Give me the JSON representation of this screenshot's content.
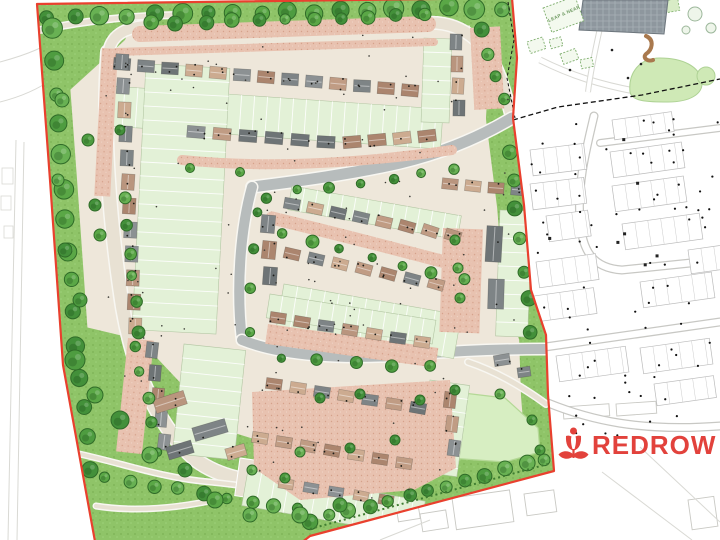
{
  "labels": {
    "play_area": "LEAP & NEAP",
    "brand": "REDROW"
  },
  "logo": {
    "text": "REDROW",
    "color": "#e2423c",
    "x": 592,
    "y": 454,
    "size": 26
  },
  "colors": {
    "boundary_red": "#e9402e",
    "base": "#eee7da",
    "grass": "#8fc468",
    "grass_dot1": "#7cb254",
    "grass_dot2": "#9ed27a",
    "lawn_edge": "#7ab153",
    "basin": "#d7eec2",
    "basin_edge": "#b4d896",
    "road_gray": "#b7bcbc",
    "road_beige": "#e8e1d3",
    "road_casing": "#f8f7f2",
    "salmon": "#e8c2b0",
    "salmon_dot": "#d5a18b",
    "garden": "#e3f1d7",
    "garden_edge": "#b3c6a3",
    "roofs": [
      "#6e7476",
      "#b9957e",
      "#ccab90",
      "#7e8486",
      "#ab856e",
      "#8c9193",
      "#c09c84"
    ],
    "tree_fills": [
      "#5aa746",
      "#4e9c40",
      "#68b153",
      "#43903a"
    ],
    "tree_edge": "#2f6b28",
    "estate_line": "#bbbbbb",
    "estate_road": "#c8c8c4",
    "faint": "#d9d9d4",
    "panel": "#8e979e",
    "panel_line": "#a8b1b6",
    "play_green": "#7fae6e",
    "blob": "#cfe9b6",
    "blob_edge": "#aed294",
    "squiggle": "#a9794e",
    "hedge": "#3f7d31"
  },
  "map": {
    "boundary": [
      [
        37,
        4
      ],
      [
        512,
        -2
      ],
      [
        517,
        58
      ],
      [
        513,
        118
      ],
      [
        524,
        205
      ],
      [
        531,
        290
      ],
      [
        546,
        335
      ],
      [
        548,
        395
      ],
      [
        554,
        471
      ],
      [
        310,
        536
      ],
      [
        296,
        547
      ],
      [
        96,
        547
      ],
      [
        63,
        365
      ],
      [
        50,
        180
      ]
    ],
    "dash_main": [
      [
        513,
        120
      ],
      [
        558,
        107
      ],
      [
        642,
        95
      ],
      [
        720,
        79
      ]
    ],
    "dash_inner": [
      [
        508,
        2
      ],
      [
        514,
        40
      ],
      [
        507,
        78
      ],
      [
        515,
        118
      ]
    ],
    "hedge_line": [
      [
        310,
        529
      ],
      [
        548,
        464
      ]
    ],
    "lawns": [
      [
        [
          38,
          5
        ],
        [
          140,
          2
        ],
        [
          125,
          40
        ],
        [
          70,
          90
        ],
        [
          48,
          60
        ]
      ],
      [
        [
          56,
          320
        ],
        [
          140,
          340
        ],
        [
          225,
          430
        ],
        [
          305,
          455
        ],
        [
          315,
          510
        ],
        [
          95,
          545
        ],
        [
          60,
          360
        ]
      ],
      [
        [
          96,
          460
        ],
        [
          180,
          492
        ],
        [
          260,
          505
        ],
        [
          340,
          500
        ],
        [
          430,
          462
        ],
        [
          470,
          430
        ],
        [
          500,
          420
        ],
        [
          548,
          440
        ],
        [
          554,
          470
        ],
        [
          310,
          535
        ],
        [
          98,
          544
        ]
      ],
      [
        [
          470,
          10
        ],
        [
          512,
          0
        ],
        [
          516,
          60
        ],
        [
          514,
          118
        ],
        [
          497,
          110
        ],
        [
          470,
          40
        ]
      ],
      [
        [
          505,
          120
        ],
        [
          516,
          120
        ],
        [
          530,
          290
        ],
        [
          545,
          335
        ],
        [
          548,
          400
        ],
        [
          536,
          400
        ],
        [
          522,
          300
        ],
        [
          508,
          200
        ]
      ]
    ],
    "basin": [
      [
        415,
        400
      ],
      [
        455,
        392
      ],
      [
        505,
        398
      ],
      [
        538,
        428
      ],
      [
        540,
        452
      ],
      [
        505,
        462
      ],
      [
        450,
        458
      ],
      [
        418,
        430
      ]
    ],
    "roads_beige": [
      {
        "d": "M108,52 C102,130 110,220 120,290 C128,352 150,420 196,460 C220,478 248,482 300,488",
        "w": 13
      },
      {
        "d": "M108,55 C110,36 124,27 148,26",
        "w": 10
      },
      {
        "d": "M40,30 C90,20 130,16 176,15",
        "w": 5
      },
      {
        "d": "M425,23 C465,20 492,48 503,86 C508,102 510,112 512,118",
        "w": 11
      },
      {
        "d": "M468,362 C498,372 524,388 546,404",
        "w": 5
      },
      {
        "d": "M70,452 C120,462 160,478 210,482 C252,486 282,492 306,500",
        "w": 4
      },
      {
        "d": "M96,506 C140,513 185,507 224,498",
        "w": 4
      }
    ],
    "roads_gray": [
      {
        "d": "M512,118 C482,136 446,152 400,163 C352,174 300,181 252,187",
        "w": 11
      },
      {
        "d": "M252,187 C240,230 236,290 242,340",
        "w": 10
      },
      {
        "d": "M242,340 C280,355 340,361 420,354 C470,350 515,349 546,349",
        "w": 10
      }
    ],
    "court": [
      240,
      458,
      66,
      38,
      8
    ],
    "salmon_rects": [
      [
        443,
        228,
        40,
        104,
        2
      ],
      [
        102,
        48,
        16,
        148,
        3
      ],
      [
        128,
        338,
        26,
        114,
        6
      ],
      [
        268,
        324,
        172,
        20,
        8
      ],
      [
        470,
        28,
        30,
        82,
        -3
      ]
    ],
    "salmon_paths": [
      {
        "d": "M140,34 L428,24",
        "w": 16
      },
      {
        "d": "M182,160 Q300,172 452,150",
        "w": 10
      },
      {
        "d": "M272,218 Q362,240 468,268",
        "w": 13
      },
      {
        "d": "M116,52 L434,42",
        "w": 8
      }
    ],
    "salmon_polys": [
      [
        [
          252,
          392
        ],
        [
          450,
          380
        ],
        [
          456,
          468
        ],
        [
          414,
          490
        ],
        [
          300,
          500
        ],
        [
          254,
          468
        ]
      ]
    ],
    "gardens": [
      [
        112,
        86,
        332,
        40,
        4,
        13,
        "v"
      ],
      [
        292,
        186,
        172,
        24,
        10,
        13,
        "v"
      ],
      [
        284,
        284,
        180,
        44,
        10,
        14,
        "v"
      ],
      [
        146,
        64,
        84,
        266,
        3,
        14,
        "h"
      ],
      [
        184,
        344,
        62,
        110,
        6,
        14,
        "h"
      ],
      [
        500,
        210,
        32,
        126,
        2,
        14,
        "h"
      ],
      [
        424,
        38,
        28,
        84,
        2,
        14,
        "h"
      ],
      [
        430,
        380,
        40,
        92,
        8,
        14,
        "h"
      ],
      [
        248,
        470,
        180,
        36,
        10,
        14,
        "v"
      ],
      [
        270,
        294,
        168,
        24,
        9,
        13,
        "v"
      ]
    ],
    "houses": [
      [
        122,
        64,
        24,
        2.2,
        13,
        4,
        17,
        12,
        0
      ],
      [
        196,
        132,
        26,
        2,
        6,
        4,
        18,
        12,
        0
      ],
      [
        352,
        142,
        25,
        -2,
        4,
        -6,
        18,
        12,
        0
      ],
      [
        456,
        42,
        1,
        22,
        4,
        2,
        12,
        16,
        0
      ],
      [
        292,
        204,
        23,
        4.5,
        8,
        10,
        16,
        11,
        1.2
      ],
      [
        292,
        254,
        24,
        5,
        7,
        12,
        16,
        11,
        0.8
      ],
      [
        278,
        318,
        24,
        4,
        7,
        9,
        16,
        11,
        0
      ],
      [
        122,
        62,
        1.2,
        24,
        12,
        3,
        13,
        16,
        0
      ],
      [
        152,
        350,
        3,
        23,
        5,
        6,
        12,
        16,
        0
      ],
      [
        170,
        402,
        0,
        0,
        1,
        -17,
        32,
        14,
        0
      ],
      [
        210,
        430,
        0,
        0,
        1,
        -17,
        34,
        14,
        0
      ],
      [
        180,
        450,
        0,
        0,
        1,
        -17,
        26,
        13,
        0
      ],
      [
        236,
        452,
        0,
        0,
        1,
        -17,
        20,
        12,
        0
      ],
      [
        450,
        184,
        23,
        2,
        4,
        5,
        16,
        11,
        0
      ],
      [
        494,
        244,
        0,
        0,
        1,
        2,
        16,
        36,
        0
      ],
      [
        496,
        294,
        0,
        0,
        1,
        2,
        16,
        30,
        0
      ],
      [
        502,
        360,
        0,
        0,
        1,
        -8,
        16,
        11,
        0
      ],
      [
        524,
        372,
        0,
        0,
        1,
        -8,
        13,
        10,
        0
      ],
      [
        274,
        384,
        24,
        4,
        7,
        9,
        16,
        11,
        0
      ],
      [
        260,
        438,
        24,
        4.2,
        7,
        10,
        16,
        11,
        0
      ],
      [
        286,
        484,
        25,
        4,
        5,
        10,
        15,
        10,
        0
      ],
      [
        450,
        400,
        2,
        24,
        3,
        8,
        12,
        16,
        0
      ],
      [
        268,
        224,
        1,
        26,
        3,
        5,
        14,
        18,
        0
      ]
    ],
    "tree_lines": [
      [
        48,
        16,
        500,
        8,
        26,
        8
      ],
      [
        50,
        30,
        88,
        470,
        30,
        8
      ],
      [
        150,
        22,
        425,
        16,
        27,
        6
      ],
      [
        265,
        196,
        455,
        168,
        30,
        5
      ],
      [
        280,
        232,
        462,
        280,
        28,
        5
      ],
      [
        124,
        200,
        138,
        330,
        26,
        5
      ],
      [
        136,
        345,
        158,
        450,
        26,
        5
      ],
      [
        105,
        478,
        300,
        508,
        24,
        6
      ],
      [
        310,
        522,
        545,
        460,
        20,
        6
      ],
      [
        510,
        150,
        530,
        330,
        30,
        6
      ],
      [
        480,
        30,
        505,
        100,
        24,
        6
      ],
      [
        256,
        210,
        248,
        330,
        34,
        5
      ],
      [
        280,
        360,
        430,
        368,
        36,
        5
      ]
    ],
    "tree_points": [
      [
        75,
        360,
        10
      ],
      [
        95,
        395,
        8
      ],
      [
        120,
        420,
        9
      ],
      [
        150,
        455,
        8
      ],
      [
        80,
        300,
        7
      ],
      [
        185,
        470,
        7
      ],
      [
        215,
        500,
        8
      ],
      [
        250,
        515,
        7
      ],
      [
        65,
        250,
        7
      ],
      [
        58,
        180,
        6
      ],
      [
        300,
        515,
        8
      ],
      [
        340,
        505,
        7
      ],
      [
        420,
        400,
        5
      ],
      [
        455,
        390,
        5
      ],
      [
        500,
        394,
        5
      ],
      [
        532,
        420,
        5
      ],
      [
        540,
        450,
        5
      ],
      [
        455,
        240,
        5
      ],
      [
        458,
        268,
        5
      ],
      [
        460,
        298,
        5
      ],
      [
        252,
        470,
        5
      ],
      [
        285,
        478,
        5
      ],
      [
        320,
        398,
        5
      ],
      [
        360,
        394,
        5
      ],
      [
        300,
        452,
        5
      ],
      [
        350,
        448,
        5
      ],
      [
        395,
        440,
        5
      ],
      [
        95,
        205,
        6
      ],
      [
        100,
        235,
        6
      ],
      [
        88,
        140,
        6
      ],
      [
        120,
        130,
        5
      ],
      [
        190,
        168,
        4.5
      ],
      [
        240,
        172,
        4.5
      ],
      [
        62,
        100,
        7
      ],
      [
        45,
        440,
        7
      ]
    ],
    "specks": {
      "n": 120,
      "seed": 11
    },
    "estate": {
      "roads": [
        {
          "d": "M594,116 C586,150 577,185 580,220 C582,250 592,268 622,270 L720,260",
          "w": 9
        },
        {
          "d": "M600,143 L720,128",
          "w": 8
        },
        {
          "d": "M545,347 L720,322",
          "w": 9
        },
        {
          "d": "M548,403 C590,420 640,432 720,426",
          "w": 9
        }
      ],
      "blocks": [
        [
          530,
          150,
          54,
          26,
          -7
        ],
        [
          530,
          184,
          54,
          26,
          -7
        ],
        [
          536,
          262,
          60,
          26,
          -8
        ],
        [
          534,
          296,
          60,
          26,
          -8
        ],
        [
          610,
          152,
          72,
          26,
          -8
        ],
        [
          612,
          186,
          72,
          26,
          -8
        ],
        [
          622,
          224,
          78,
          26,
          -8
        ],
        [
          640,
          282,
          72,
          26,
          -8
        ],
        [
          556,
          356,
          70,
          26,
          -8
        ],
        [
          640,
          348,
          70,
          26,
          -8
        ],
        [
          654,
          384,
          60,
          22,
          -8
        ],
        [
          546,
          216,
          42,
          26,
          -8
        ],
        [
          688,
          250,
          40,
          24,
          -8
        ],
        [
          612,
          120,
          60,
          20,
          -8
        ]
      ],
      "dots_region": [
        528,
        118,
        190,
        320
      ],
      "n_dots": 85,
      "n_squares": 7,
      "seed": 5
    },
    "park": {
      "building": [
        [
          583,
          0
        ],
        [
          668,
          0
        ],
        [
          664,
          34
        ],
        [
          579,
          30
        ]
      ],
      "play_squares": [
        [
          543,
          8,
          34,
          26,
          -20
        ],
        [
          527,
          42,
          16,
          12,
          -18
        ],
        [
          549,
          40,
          12,
          9,
          -15
        ],
        [
          560,
          54,
          16,
          11,
          -20
        ],
        [
          580,
          60,
          12,
          9,
          -12
        ]
      ],
      "blob1": "M630,92 C628,72 640,58 660,58 C682,58 700,66 702,82 C703,94 690,102 668,102 C650,102 632,102 630,92 Z",
      "blob2": [
        706,
        76,
        9
      ],
      "hatch_rect": [
        658,
        2,
        20,
        12,
        -10
      ],
      "squiggle": "M646,36 C655,40 652,50 646,54 C642,58 648,62 653,60",
      "outline_trees": [
        [
          695,
          14,
          7
        ],
        [
          711,
          28,
          5
        ],
        [
          686,
          30,
          4
        ]
      ],
      "paths": [
        {
          "d": "M540,60 C570,75 600,85 640,92",
          "w": 7
        },
        {
          "d": "M606,0 C600,30 592,60 588,92",
          "w": 6
        }
      ],
      "dots": [
        [
          628,
          78
        ],
        [
          641,
          64
        ],
        [
          612,
          50
        ],
        [
          570,
          70
        ]
      ],
      "label_pos": [
        549,
        22,
        -24
      ]
    },
    "outside": {
      "west_lines": [
        "M16,140 L8,540",
        "M24,142 L17,540",
        "M0,62 C30,54 46,46 58,38",
        "M0,102 C24,96 40,88 54,78"
      ],
      "west_rects": [
        [
          2,
          168,
          11,
          16,
          0
        ],
        [
          1,
          196,
          10,
          14,
          0
        ],
        [
          4,
          226,
          9,
          12,
          0
        ]
      ],
      "bottom_rects": [
        [
          452,
          498,
          58,
          32,
          -8
        ],
        [
          524,
          494,
          30,
          22,
          -8
        ],
        [
          396,
          506,
          22,
          16,
          -9
        ],
        [
          420,
          514,
          26,
          18,
          -9
        ],
        [
          563,
          407,
          46,
          12,
          -4
        ],
        [
          616,
          404,
          40,
          12,
          -4
        ],
        [
          688,
          500,
          26,
          30,
          -8
        ]
      ],
      "bottom_lines": [
        "M640,447 L720,522",
        "M602,472 L692,540",
        "M380,540 L430,520"
      ]
    }
  }
}
